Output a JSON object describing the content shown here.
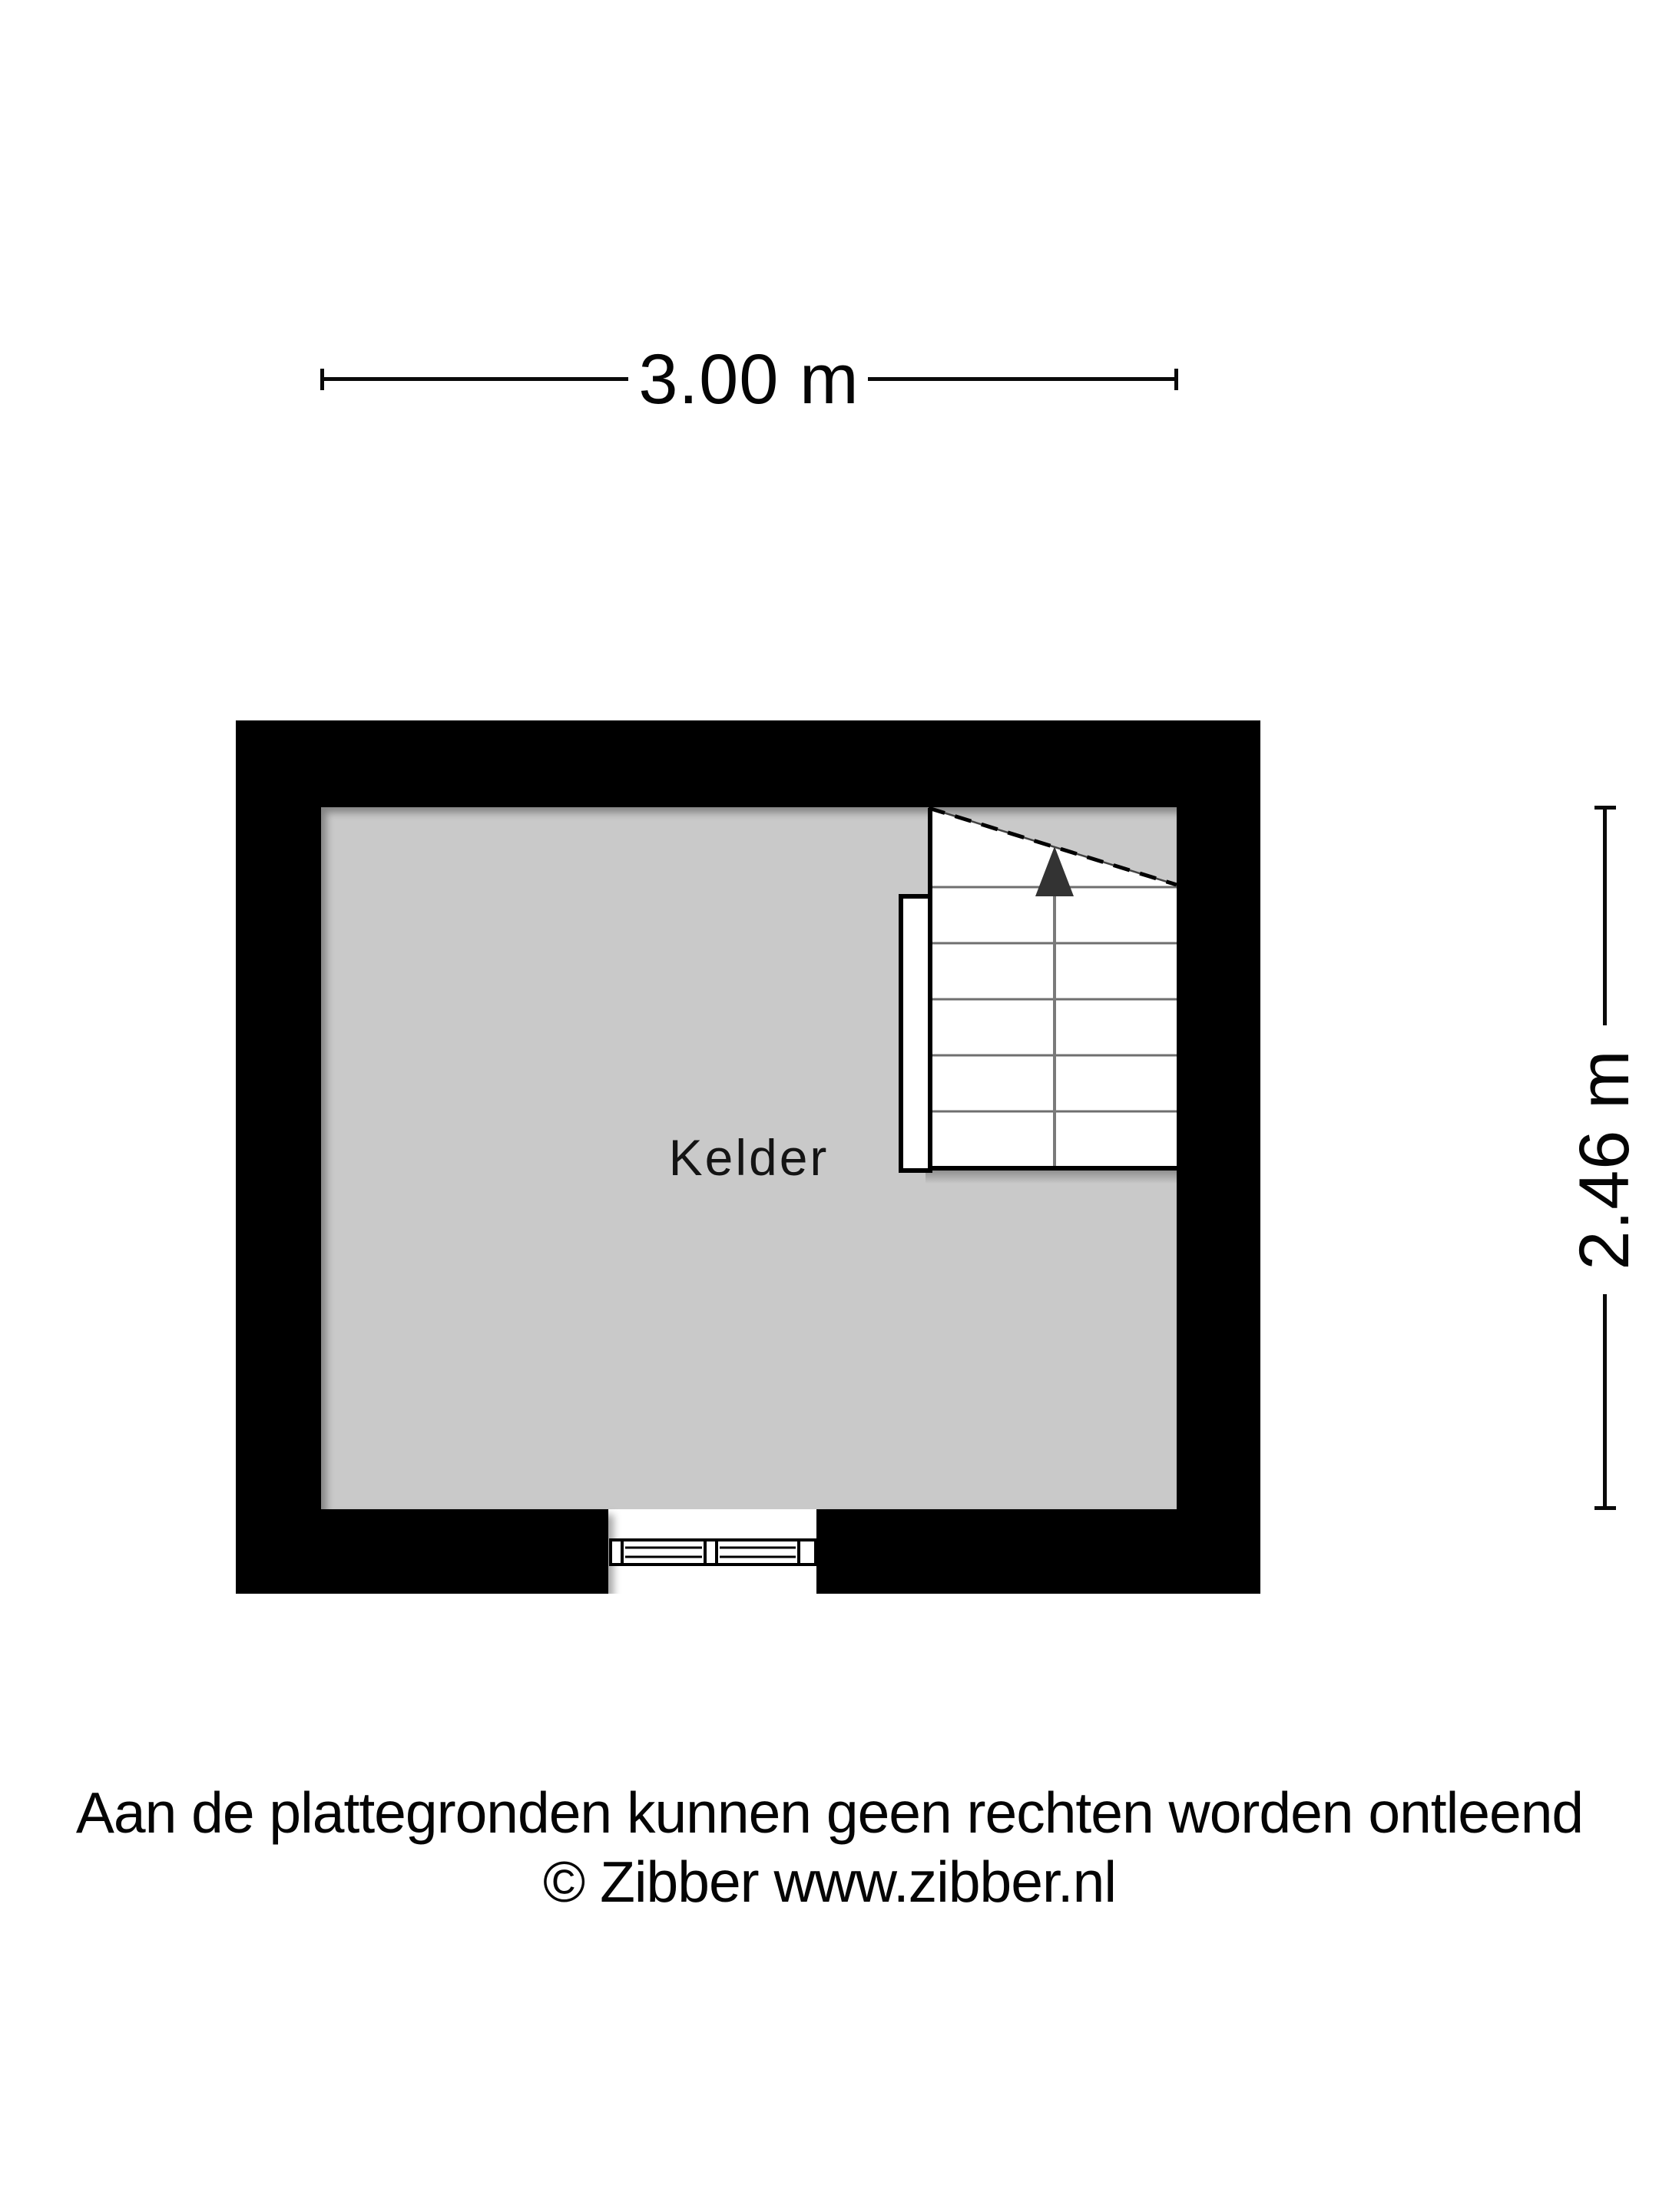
{
  "floorplan": {
    "room_label": "Kelder",
    "width_dimension": "3.00 m",
    "height_dimension": "2.46 m"
  },
  "footer": {
    "disclaimer": "Aan de plattegronden kunnen geen rechten worden ontleend",
    "credit": "© Zibber www.zibber.nl"
  },
  "colors": {
    "wall": "#000000",
    "floor": "#c9c9c9",
    "page_bg": "#ffffff",
    "tread_line": "#6f6f6f",
    "stair_center_line": "#7a7a7a",
    "arrow": "#333333",
    "dimension_line": "#0a0a0a"
  }
}
